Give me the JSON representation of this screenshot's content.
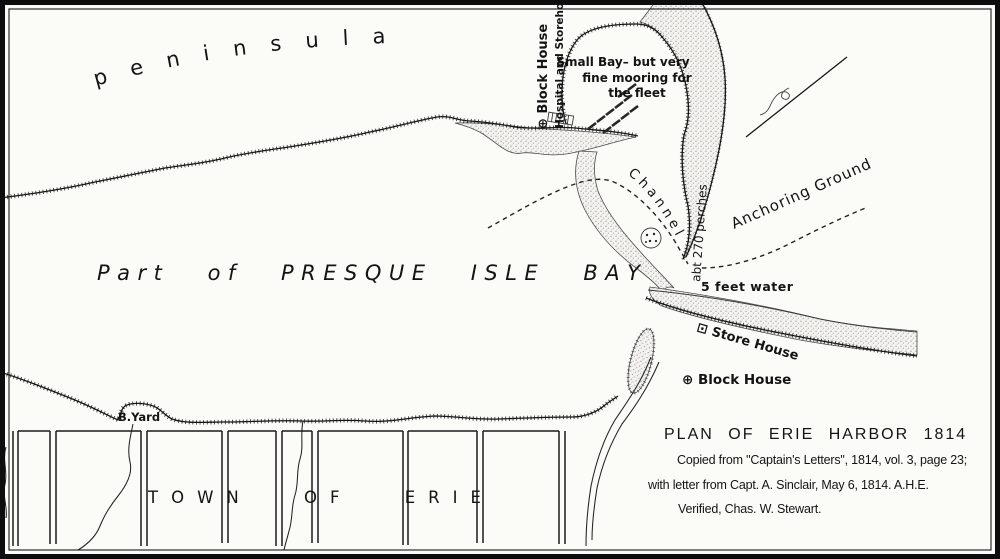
{
  "map": {
    "peninsula_label": "peninsula",
    "bay_label": "Part of PRESQUE ISLE BAY",
    "town_label": "TOWN OF ERIE",
    "b_yard_label": "B.Yard",
    "blockhouse_hospital": {
      "line1": "⊕ Block House",
      "line2": "Hospital and Storehouse"
    },
    "small_bay_note": {
      "line1": "Small Bay– but very",
      "line2": "fine mooring for",
      "line3": "the fleet"
    },
    "channel_label": "Channel",
    "perches_label": "abt 270 perches",
    "anchoring_ground_label": "Anchoring Ground",
    "depth_label": "5 feet water",
    "store_house_label": "⊡ Store House",
    "block_house_label": "⊕ Block House",
    "title_block": {
      "title": "PLAN OF ERIE HARBOR 1814",
      "source_line": "Copied from \"Captain's Letters\", 1814, vol. 3, page 23;",
      "letter_line": "with letter from Capt. A. Sinclair, May 6, 1814.  A.H.E.",
      "verified_line": "Verified, Chas. W. Stewart."
    }
  }
}
